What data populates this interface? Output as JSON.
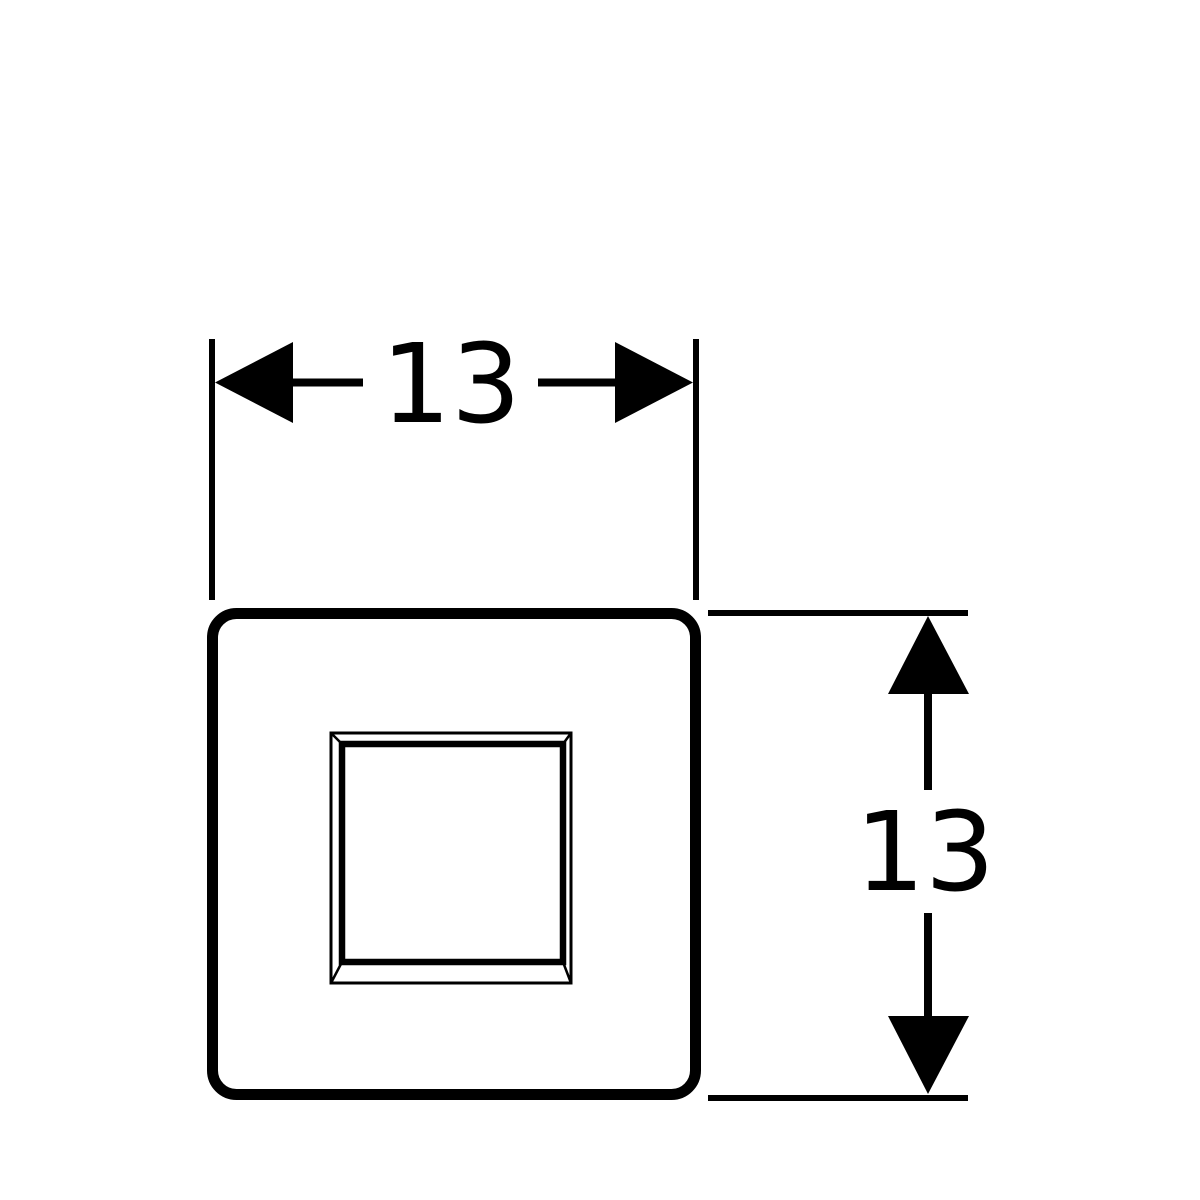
{
  "colors": {
    "line": "#000000",
    "background": "#ffffff"
  },
  "diagram": {
    "type": "technical-dimension-drawing",
    "subject": "square flush plate with central beveled button",
    "width_dimension": {
      "label": "13"
    },
    "height_dimension": {
      "label": "13"
    }
  }
}
